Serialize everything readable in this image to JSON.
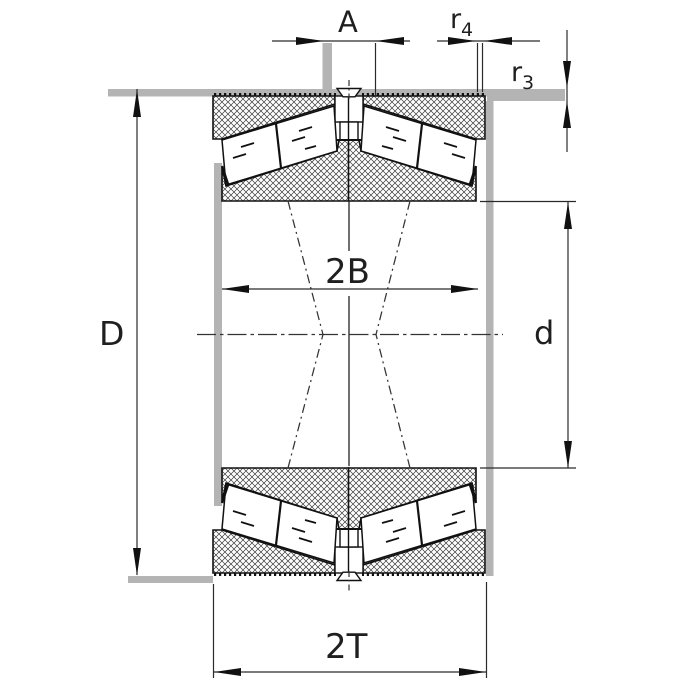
{
  "drawing": {
    "type": "bearing-cross-section",
    "description_labels": {
      "a": "A",
      "r4_base": "r",
      "r4_sub": "4",
      "r3_base": "r",
      "r3_sub": "3",
      "outer_diameter": "D",
      "inner_width": "2B",
      "bore_diameter": "d",
      "total_width": "2T"
    },
    "colors": {
      "line": "#1a1a1a",
      "dimension_line": "#2a2a2a",
      "abutment_gray": "#b4b4b4",
      "hatch": "#3b3b3b",
      "background": "#ffffff"
    }
  }
}
